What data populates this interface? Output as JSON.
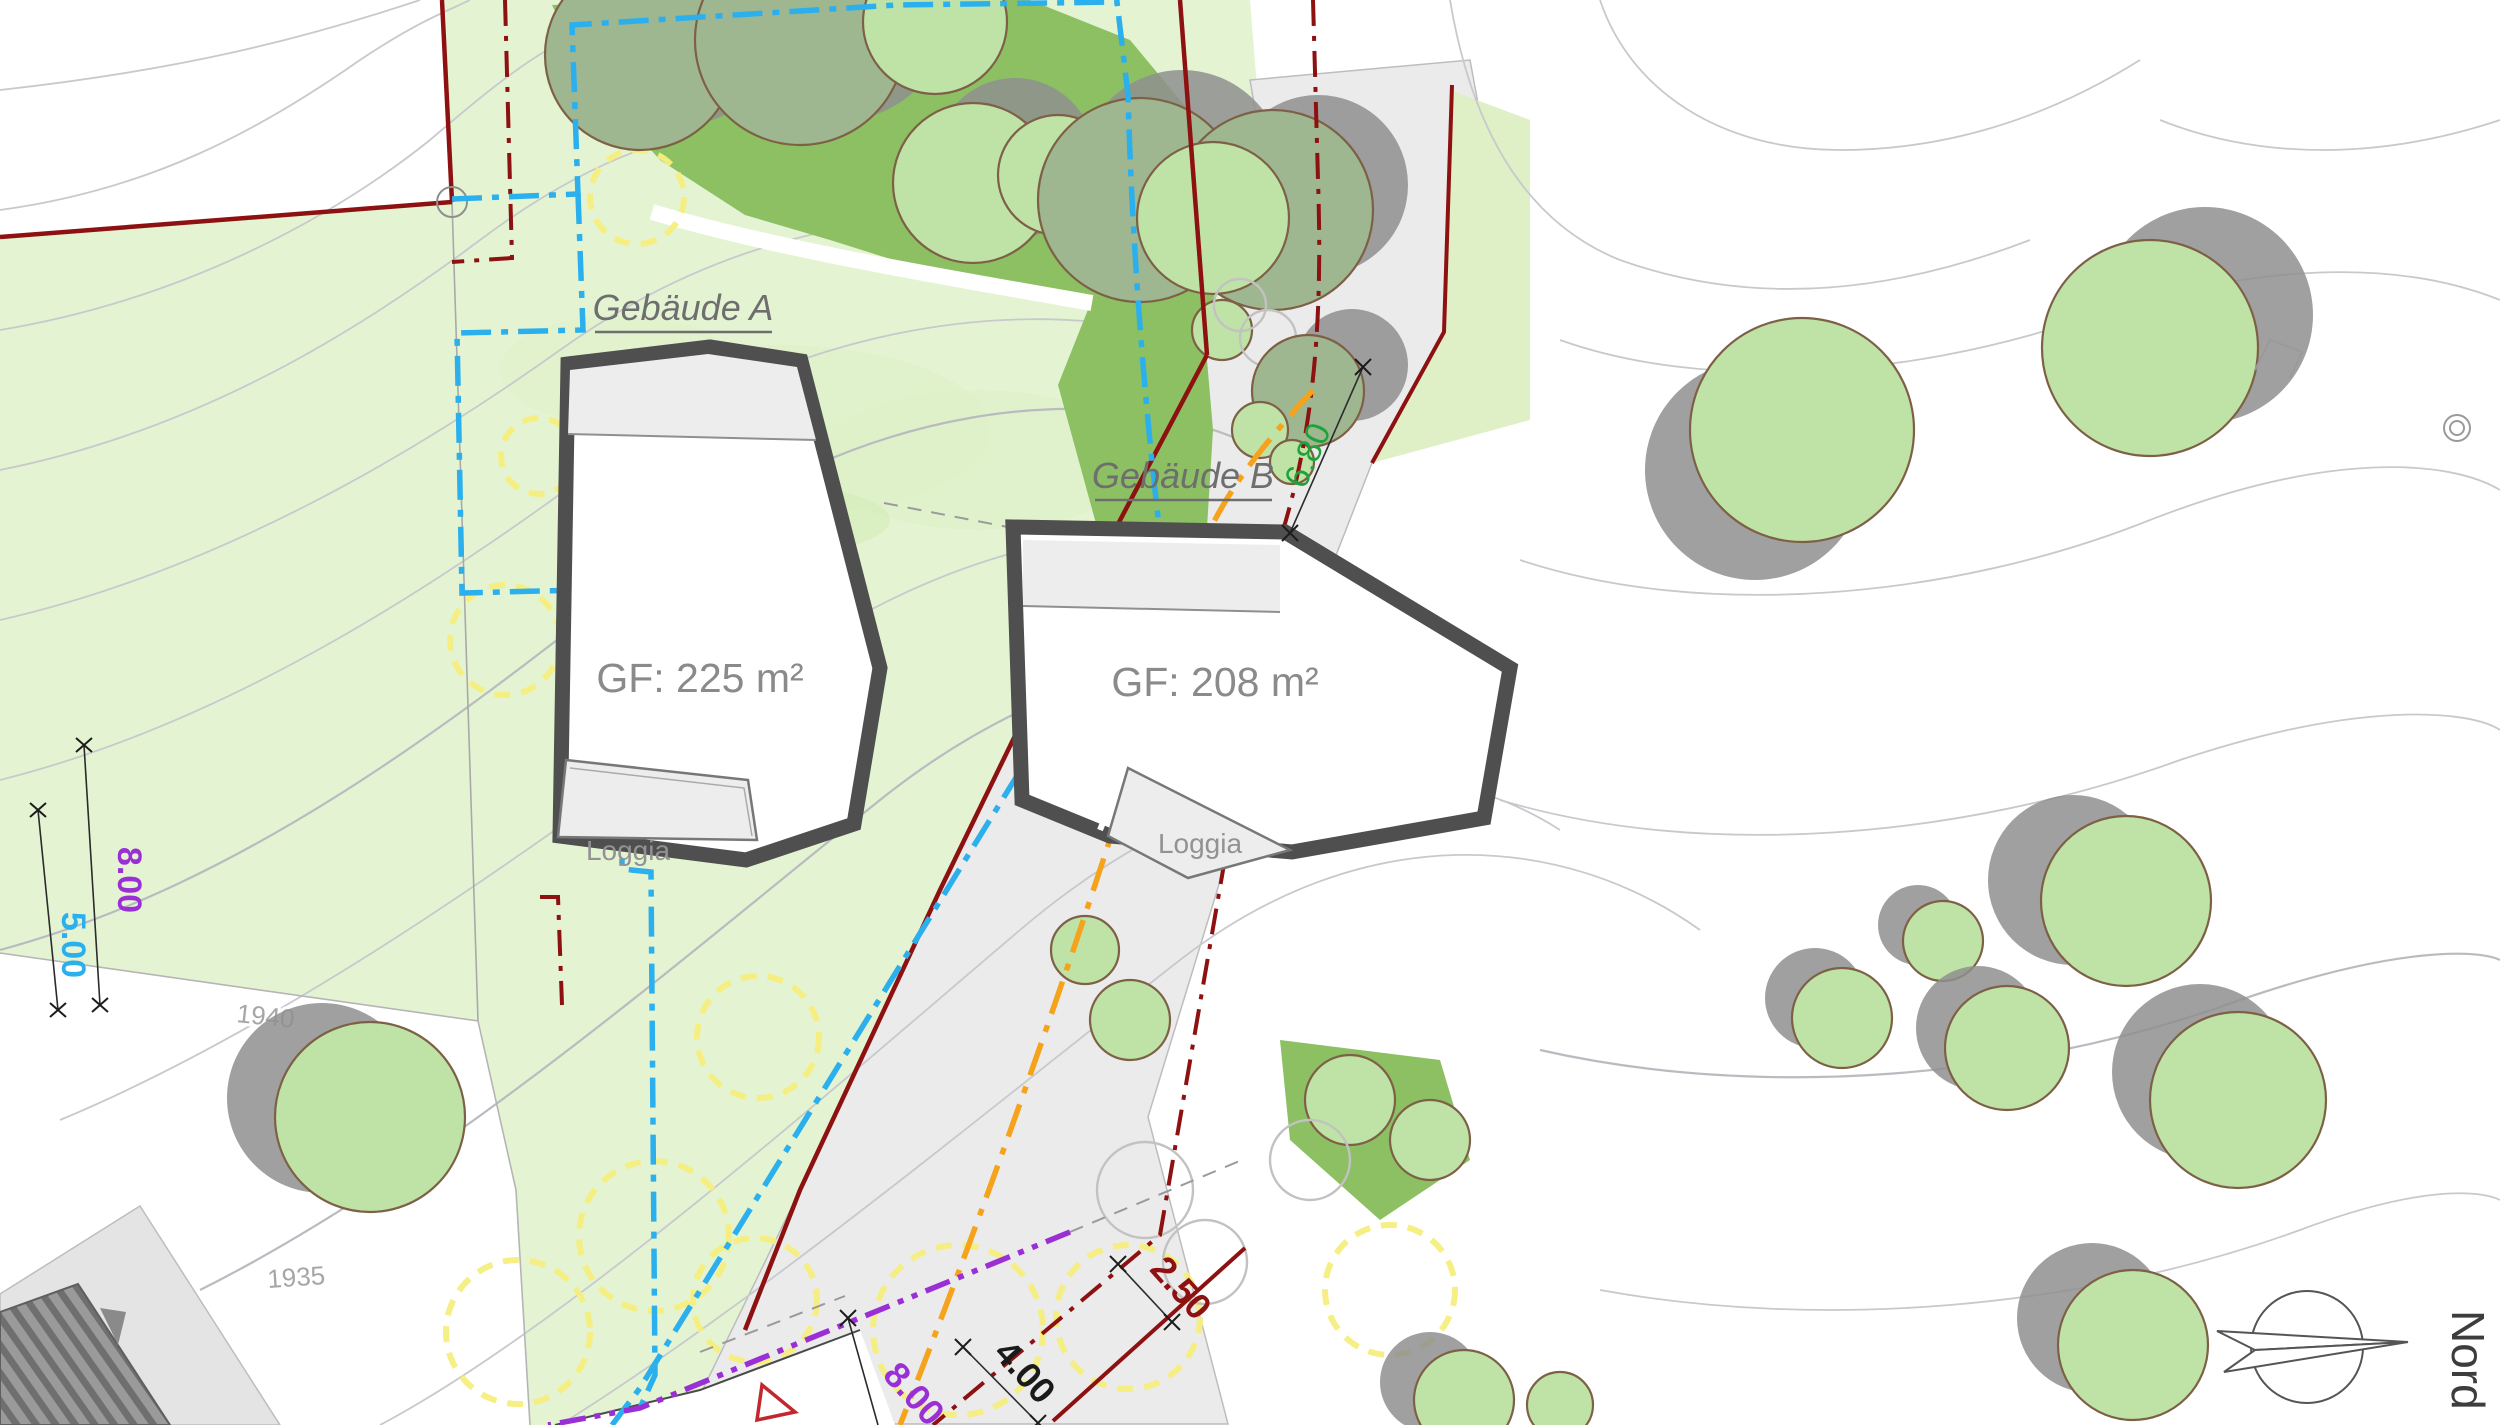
{
  "plan": {
    "labels": {
      "building_a": "Gebäude A",
      "building_b": "Gebäude B",
      "gf_a": "GF: 225 m²",
      "gf_b": "GF: 208 m²",
      "loggia_a": "Loggia",
      "loggia_b": "Loggia",
      "north": "Nord"
    },
    "dimensions": {
      "tree_distance": "6.80",
      "setback_left_outer": "8.00",
      "setback_left_inner": "5.00",
      "road_strip": "2.50",
      "road_setback": "4.00",
      "bottom_setback": "8.00"
    },
    "contour_labels": {
      "c1940": "1940",
      "c1935": "1935"
    },
    "colors": {
      "plot_green": "#e4f4d2",
      "forest_green": "#8cc063",
      "tree_light_green": "#bfe3a6",
      "tree_gray_green": "#9fb790",
      "tree_shadow_gray": "#8f8f8f",
      "road_gray": "#ebebeb",
      "boundary_red": "#8e1111",
      "setback_cyan": "#2bb0ed",
      "line_orange": "#f5a31c",
      "line_purple": "#9b2fd6",
      "crown_yellow": "#f6ee7e",
      "building_outline": "#4f4f4f",
      "dim_green": "#1fa23c"
    }
  }
}
